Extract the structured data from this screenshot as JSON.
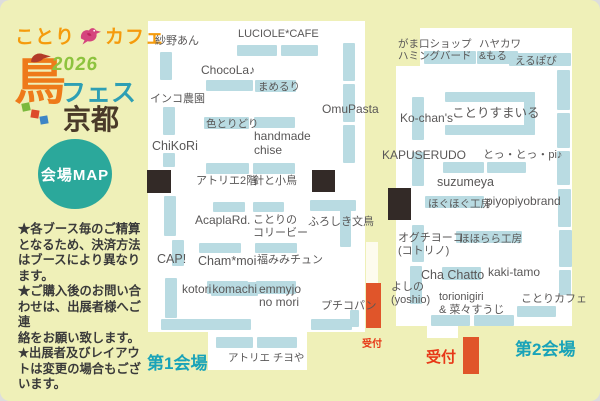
{
  "colors": {
    "background": "#eff0b8",
    "booth_bar_teal": "#b9dbe2",
    "black_block": "#332a27",
    "reception_orange_bar": "#e0552a",
    "reception_red_text": "#e73817",
    "venue_label_teal": "#19a3b8",
    "logo_orange": "#f59b0c",
    "logo_green": "#8dc33e",
    "logo_fes_teal": "#2e9fb4",
    "logo_kyoto_brown": "#4a3a29",
    "badge_green": "#2ba89b",
    "map_text_gray": "#595757"
  },
  "logo": {
    "kotori": "ことり",
    "cafe": "カフェ",
    "year": "2026",
    "bird_kanji": "鳥",
    "fes": "フェス",
    "kyoto": "京都"
  },
  "badge": {
    "label": "会場MAP"
  },
  "notes": {
    "text": "★各ブース毎のご精算\nとなるため、決済方法\nはブースにより異なり\nます。\n★ご購入後のお問い合\nわせは、出展者様へご連\n絡をお願い致します。\n★出展者及びレイアウ\nトは変更の場合もござ\nいます。"
  },
  "venue1": {
    "label": "第1会場",
    "reception": "受付",
    "booths": {
      "sayano_an": "紗野あん",
      "luciole_cafe": "LUCIOLE*CAFE",
      "chocola": "ChocoLa♪",
      "mameruri": "まめるり",
      "inko_nouen": "インコ農園",
      "omupasta": "OmuPasta",
      "chikori": "ChiKoRi",
      "irotoridori": "色とりどり",
      "handmade_chise": "handmade\nchise",
      "atelier_2f": "アトリエ2階",
      "hari_to_kotori": "針と小鳥",
      "acapla_rd": "AcaplaRd.",
      "kotorino_koribi": "ことりの\nコリービー",
      "furoshiki_buncho": "ふろしき文鳥",
      "cap": "CAP!",
      "cham_moi": "Cham*moi",
      "fukumimi_chun": "福みみチュン",
      "kotorikomachi": {
        "prefix": "kotori",
        "highlight": "komachi"
      },
      "emmyjo_no_mori": {
        "highlight": "emmyjo",
        "rest": "no mori"
      },
      "petit_copain": "プチコパン",
      "atelier_chiyoya": "アトリエ チヨや"
    }
  },
  "venue2": {
    "label": "第2会場",
    "reception": "受付",
    "booths": {
      "gamaguchi_shop": "がま口ショップ\nハミングバード",
      "hayakawa_moru": "ハヤカワ\n&もる",
      "erupopi": "えるぽぴ",
      "ko_chans": "Ko-chan's",
      "kotori_sumairu": "ことりすまいる",
      "kapuserudo": "KAPUSERUDO",
      "totto_pi": "とっ・とっ・pi♪",
      "suzumeya": "suzumeya",
      "hoguhogu_kobo": "ほぐほぐ工房",
      "piyopiyobrand": "piyopiyobrand",
      "oguchi_yoko": "オグチヨーコ\n(コトリノ)",
      "hohorara_kobo": "ほほらら工房",
      "cha_chatto": "Cha Chatto",
      "kaki_tamo": "kaki-tamo",
      "yoshino": "よしの\n(yoshio)",
      "torionigiri": "torionigiri\n& 菜々すうじ",
      "kotori_cafe": "ことりカフェ"
    }
  }
}
